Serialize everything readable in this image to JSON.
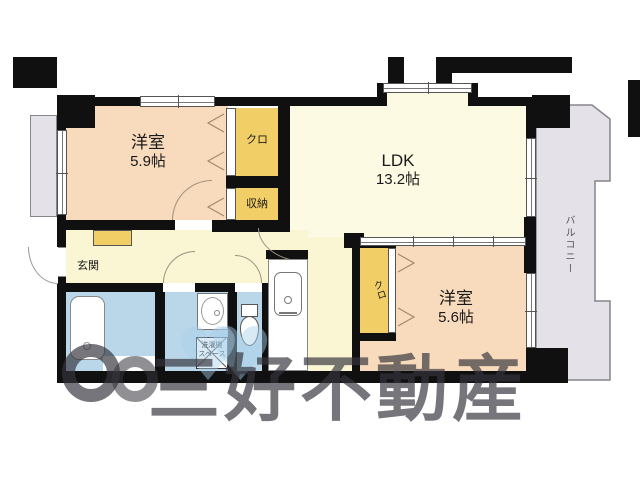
{
  "plan": {
    "room1": {
      "name": "洋室",
      "size": "5.9帖"
    },
    "ldk": {
      "name": "LDK",
      "size": "13.2帖"
    },
    "room2": {
      "name": "洋室",
      "size": "5.6帖"
    },
    "closet_top": {
      "label": "クロ"
    },
    "storage": {
      "label": "収納"
    },
    "closet_side": {
      "label": "クロ"
    },
    "entrance": {
      "label": "玄関"
    },
    "laundry": {
      "line1": "洗濯機",
      "line2": "スペース"
    },
    "balcony": {
      "label": "バルコニー"
    }
  },
  "watermark": {
    "text": "三好不動産"
  },
  "colors": {
    "room_peach": "#f8dabc",
    "closet_yellow": "#f2cf66",
    "ldk_cream": "#fcfae3",
    "hall_yellow": "#faf6d4",
    "wet_blue": "#b9d7e9",
    "balcony_gray": "#e4e1e8",
    "wall_black": "#111111"
  }
}
